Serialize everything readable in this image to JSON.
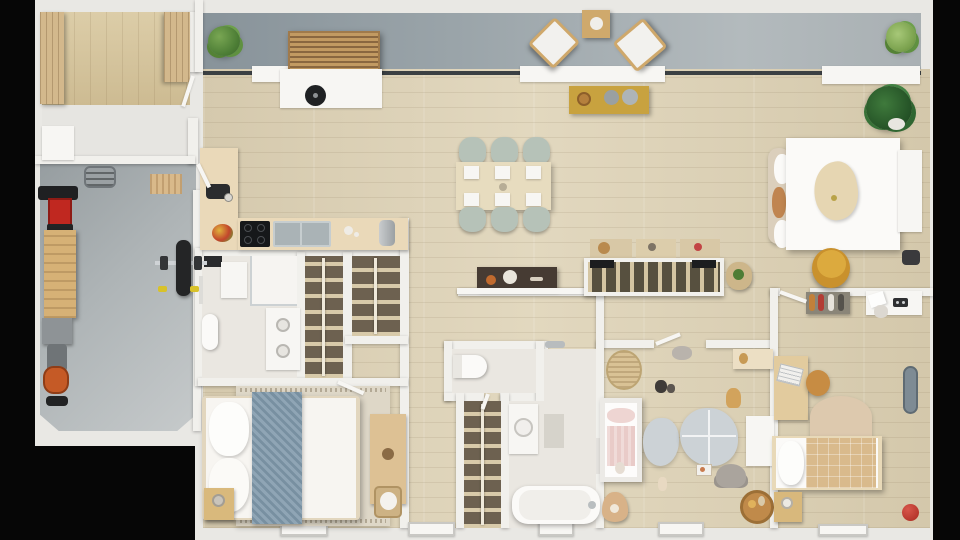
{
  "scene": {
    "title": "3D apartment floor plan – top-down render",
    "view": "top-down",
    "visible_text": [],
    "palette": {
      "background": "#060606",
      "exterior_wall": "#e9e8e4",
      "interior_wall": "#f1f0ec",
      "wood_floor": "#d9ceb3",
      "balcony_floor": "#9aa4a9",
      "garage_floor": "#aeb4b6",
      "closet_floor": "#6d6150",
      "accent_mustard": "#c8a23f",
      "accent_blue_gray": "#8099ab",
      "accent_sage": "#b6c2b8",
      "accent_red": "#c02820",
      "accent_orange": "#c55a26"
    }
  },
  "rooms": [
    {
      "name": "balcony",
      "floor": "gray-concrete",
      "furniture": [
        "potted-plant-left",
        "slatted-bench",
        "lounge-chair-1",
        "side-table",
        "lounge-chair-2",
        "potted-plant-right"
      ]
    },
    {
      "name": "entry",
      "floor": "wood-vertical-planks",
      "furniture": [
        "wardrobe-left",
        "wardrobe-right",
        "porch-bench"
      ]
    },
    {
      "name": "garage-gym",
      "floor": "concrete",
      "furniture": [
        "creeper-board",
        "doormat",
        "red-tool-cart",
        "workbench",
        "gray-cabinet",
        "lawn-mower",
        "weight-bench-with-barbell"
      ]
    },
    {
      "name": "kitchen-living-dining",
      "floor": "wood",
      "furniture": [
        "kitchen-island-with-sink",
        "kitchen-counter-L",
        "induction-cooktop",
        "double-sink",
        "coffee-machine",
        "fruit-bowl",
        "toaster",
        "dining-table",
        "six-sage-chairs",
        "mustard-console-with-bowls",
        "dark-hall-console"
      ]
    },
    {
      "name": "master-bedroom-zone",
      "floor": "wood",
      "furniture": [
        "open-hanger-rack-divider",
        "rack-pouf-with-plant",
        "double-bed-white",
        "headboard-with-cushions",
        "wood-serving-tray",
        "large-plant",
        "yellow-pouf",
        "window-sill-cabinet",
        "side-panel"
      ]
    },
    {
      "name": "bathroom-1",
      "floor": "tile",
      "furniture": [
        "shower",
        "toilet",
        "stacked-washer-dryer",
        "black-mat",
        "white-mat",
        "towel-rail"
      ]
    },
    {
      "name": "walk-in-closet-1",
      "floor": "dark",
      "furniture": [
        "hanger-rail"
      ]
    },
    {
      "name": "walk-in-closet-2",
      "floor": "dark",
      "furniture": [
        "hanger-rail"
      ]
    },
    {
      "name": "bedroom-2",
      "floor": "wood",
      "furniture": [
        "double-bed-blue-runner",
        "area-rug-fringed",
        "nightstand-with-lamp",
        "desk-dresser",
        "laundry-basket"
      ]
    },
    {
      "name": "wc",
      "floor": "tile",
      "furniture": [
        "toilet"
      ]
    },
    {
      "name": "walk-in-closet-3",
      "floor": "dark",
      "furniture": [
        "hanger-rail"
      ]
    },
    {
      "name": "bathroom-2",
      "floor": "tile",
      "furniture": [
        "vanity-sink",
        "bath-mat",
        "bathtub",
        "shower-head",
        "towel-rail"
      ]
    },
    {
      "name": "nursery",
      "floor": "wood",
      "furniture": [
        "rattan-basket",
        "wall-shelf",
        "crib-pink-bedding",
        "cloud-rug-small",
        "cloud-rug-large",
        "plush-elephant",
        "toy-giraffe",
        "toy-cat",
        "picture-book",
        "kids-table",
        "round-toy-bowl",
        "triangle-cushion",
        "small-doll"
      ]
    },
    {
      "name": "teen-bedroom",
      "floor": "wood",
      "furniture": [
        "shoe-rack",
        "wall-desk-with-outlet",
        "desk-with-laptop",
        "stool",
        "half-round-rug",
        "single-bed-checked-blanket",
        "nightstand-with-lamp",
        "skateboard",
        "red-ball"
      ]
    }
  ]
}
